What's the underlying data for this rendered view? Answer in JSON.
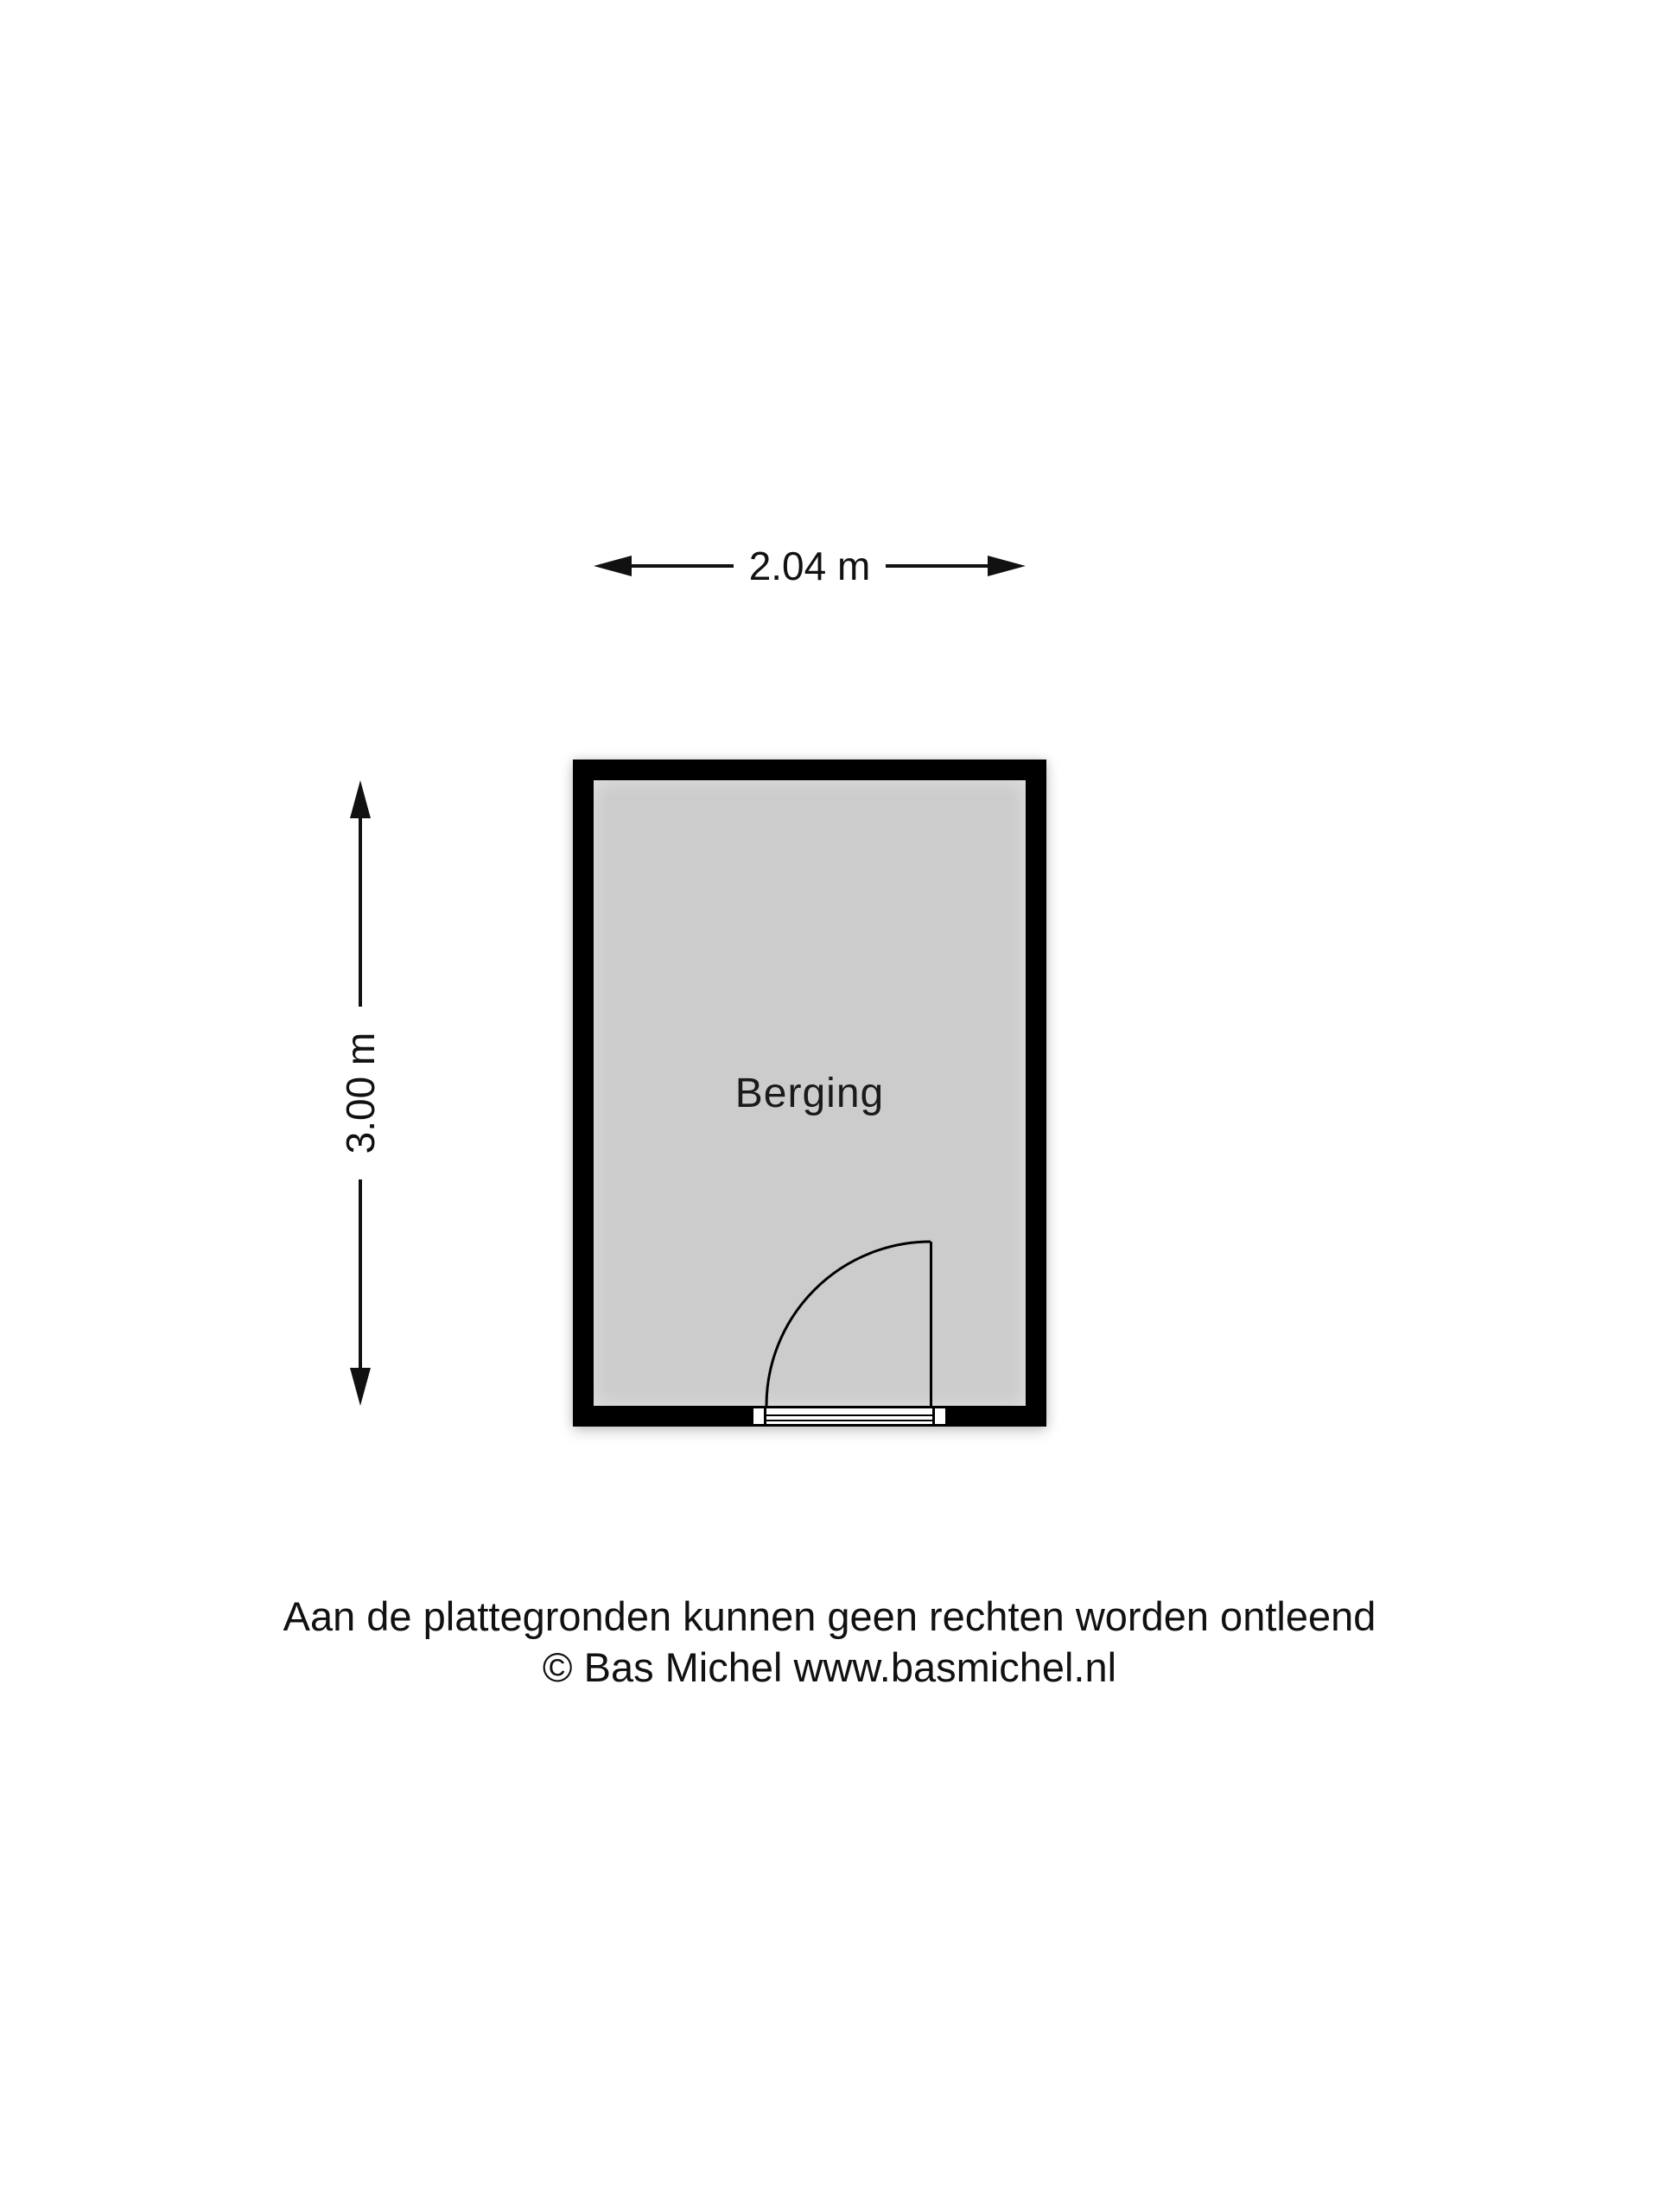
{
  "floorplan": {
    "room": {
      "label": "Berging",
      "wall_color": "#000000",
      "floor_color": "#cccccc"
    },
    "dimensions": {
      "width_label": "2.04 m",
      "height_label": "3.00 m"
    },
    "door": {
      "type": "single-swing-door",
      "position": "bottom-right"
    }
  },
  "footer": {
    "disclaimer_line1": "Aan de plattegronden kunnen geen rechten worden ontleend",
    "disclaimer_line2": "© Bas Michel www.basmichel.nl"
  }
}
